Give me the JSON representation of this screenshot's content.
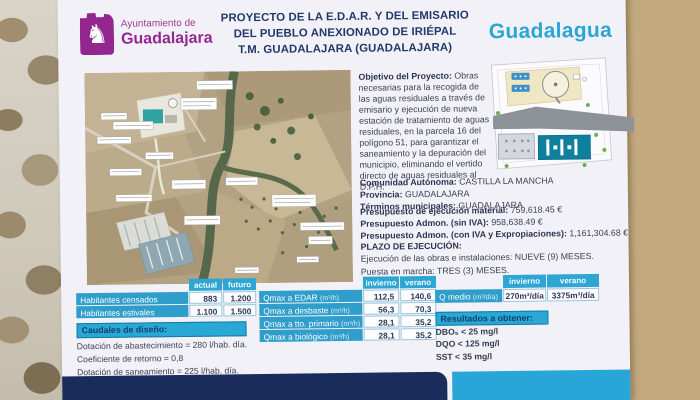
{
  "colors": {
    "brand_purple": "#93278f",
    "brand_cyan": "#29a5d6",
    "navy": "#1a2c5b",
    "title_navy": "#20386a"
  },
  "sign": {
    "logo": {
      "line1": "Ayuntamiento de",
      "line2": "Guadalajara"
    },
    "title_lines": [
      "PROYECTO DE LA E.D.A.R. Y DEL EMISARIO",
      "DEL PUEBLO ANEXIONADO DE IRIÉPAL",
      "T.M. GUADALAJARA (GUADALAJARA)"
    ],
    "brand": "Guadalagua",
    "objetivo": {
      "label": "Objetivo del Proyecto:",
      "text": "Obras necesarias para la recogida de las aguas residuales a través de emisario y ejecución de nueva estación de tratamiento de aguas residuales, en la parcela 16 del polígono 51, para garantizar el saneamiento y la depuración del municipio, eliminando el vertido directo de aguas residuales al D.P.H."
    },
    "admin": [
      {
        "label": "Comunidad Autónoma:",
        "value": "CASTILLA LA MANCHA"
      },
      {
        "label": "Provincia:",
        "value": "GUADALAJARA"
      },
      {
        "label": "Términos municipales:",
        "value": "GUADALAJARA"
      }
    ],
    "budget": [
      {
        "label": "Presupuesto de ejecución material:",
        "value": "759,618.45 €"
      },
      {
        "label": "Presupuesto Admon. (sin IVA):",
        "value": "958,638.49 €"
      },
      {
        "label": "Presupuesto Admon. (con IVA y Expropiaciones):",
        "value": "1,161,304.68 €"
      }
    ],
    "plazo": {
      "label": "PLAZO DE EJECUCIÓN:",
      "lines": [
        "Ejecución de las obras e instalaciones: NUEVE (9) MESES.",
        "Puesta en marcha: TRES (3) MESES."
      ]
    }
  },
  "tables": {
    "habitantes": {
      "headers": [
        "actual",
        "futuro"
      ],
      "rows": [
        {
          "label": "Habitantes censados",
          "values": [
            "883",
            "1.200"
          ]
        },
        {
          "label": "Habitantes estivales",
          "values": [
            "1.100",
            "1.500"
          ]
        }
      ]
    },
    "caudales": {
      "title": "Caudales de diseño:",
      "lines": [
        "Dotación de abastecimiento = 280 l/hab. día.",
        "Coeficiente de retorno = 0,8",
        "Dotación de saneamiento = 225 l/hab. día."
      ]
    },
    "qmax": {
      "headers": [
        "invierno",
        "verano"
      ],
      "rows": [
        {
          "label": "Qmax a EDAR",
          "unit": "(m³/h)",
          "values": [
            "112,5",
            "140,6"
          ]
        },
        {
          "label": "Qmax a desbaste",
          "unit": "(m³/h)",
          "values": [
            "56,3",
            "70,3"
          ]
        },
        {
          "label": "Qmax a tto. primario",
          "unit": "(m³/h)",
          "values": [
            "28,1",
            "35,2"
          ]
        },
        {
          "label": "Qmax a biológico",
          "unit": "(m³/h)",
          "values": [
            "28,1",
            "35,2"
          ]
        }
      ]
    },
    "qmedio": {
      "headers": [
        "invierno",
        "verano"
      ],
      "rows": [
        {
          "label": "Q medio",
          "unit": "(m³/día)",
          "values": [
            "270m³/día",
            "3375m³/día"
          ]
        }
      ]
    },
    "resultados": {
      "title": "Resultados a obtener:",
      "lines": [
        "DBO₅ < 25 mg/l",
        "DQO < 125 mg/l",
        "SST < 35 mg/l"
      ]
    }
  }
}
